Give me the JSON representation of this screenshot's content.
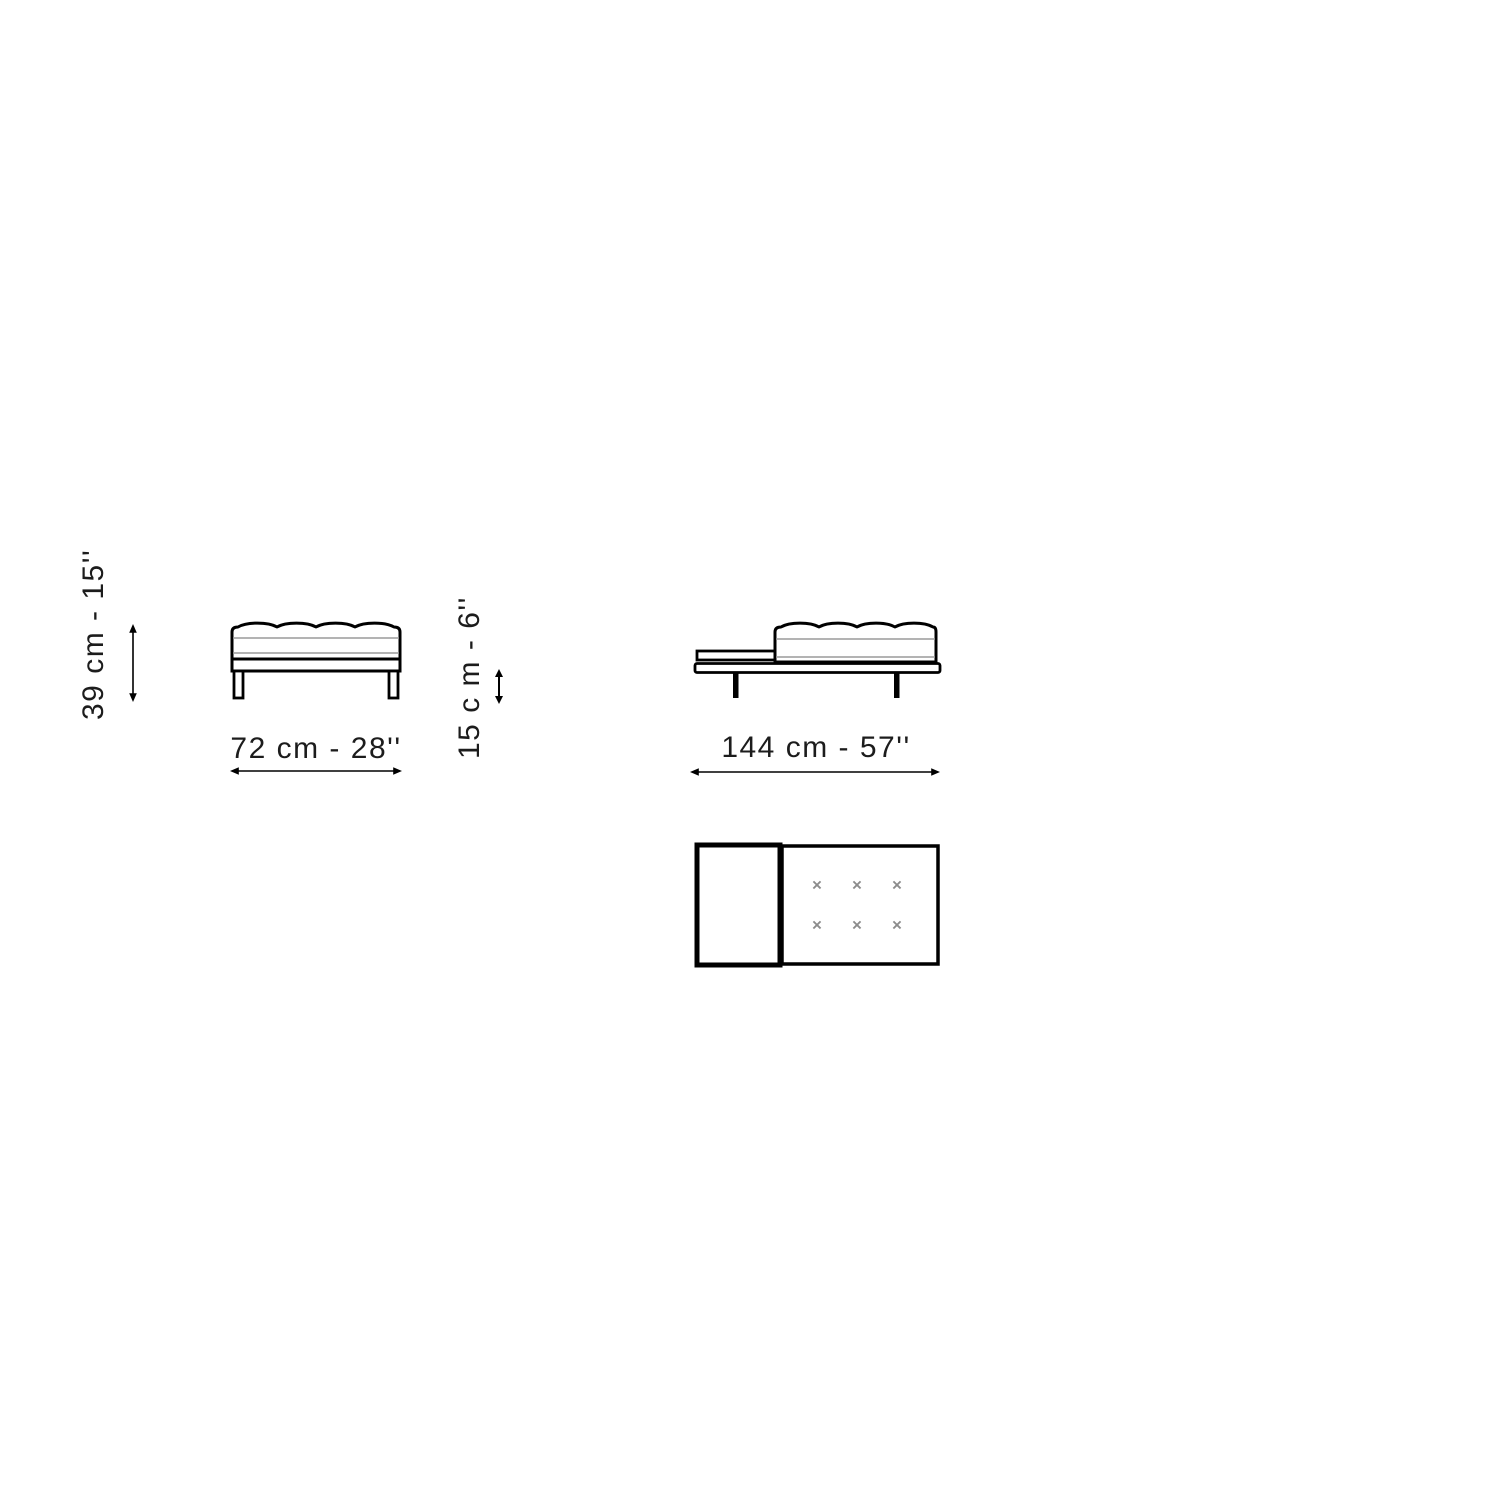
{
  "diagram": {
    "type": "furniture-dimension-drawing",
    "colors": {
      "line": "#000000",
      "thin_line": "#9a9a9a",
      "mark": "#8c8c8c",
      "text": "#1c1c1c",
      "background": "#ffffff"
    },
    "front_view": {
      "height_label": "39 cm - 15''",
      "width_label": "72 cm - 28''"
    },
    "side_view": {
      "table_height_label": "15 c m - 6''",
      "width_label": "144 cm - 57''"
    },
    "top_view": {
      "mark_symbol": "×",
      "mark_rows": 2,
      "mark_cols": 3,
      "mark_count": 6
    }
  }
}
